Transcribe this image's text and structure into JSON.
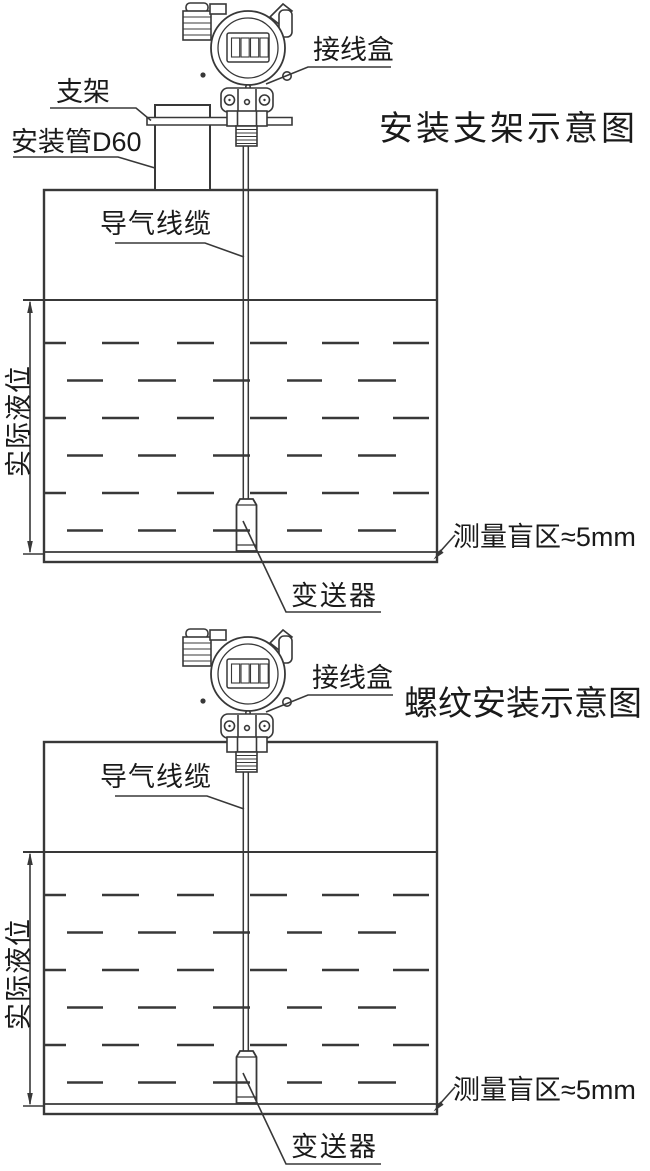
{
  "page": {
    "background": "#ffffff",
    "line_color": "#383838",
    "text_color": "#1a1a1a"
  },
  "diagram1": {
    "title": "安装支架示意图",
    "labels": {
      "junction_box": "接线盒",
      "bracket": "支架",
      "mounting_pipe": "安装管D60",
      "air_cable": "导气线缆",
      "actual_level": "实际液位",
      "blind_zone": "测量盲区≈5mm",
      "transmitter": "变送器"
    }
  },
  "diagram2": {
    "title": "螺纹安装示意图",
    "labels": {
      "junction_box": "接线盒",
      "air_cable": "导气线缆",
      "actual_level": "实际液位",
      "blind_zone": "测量盲区≈5mm",
      "transmitter": "变送器"
    }
  }
}
